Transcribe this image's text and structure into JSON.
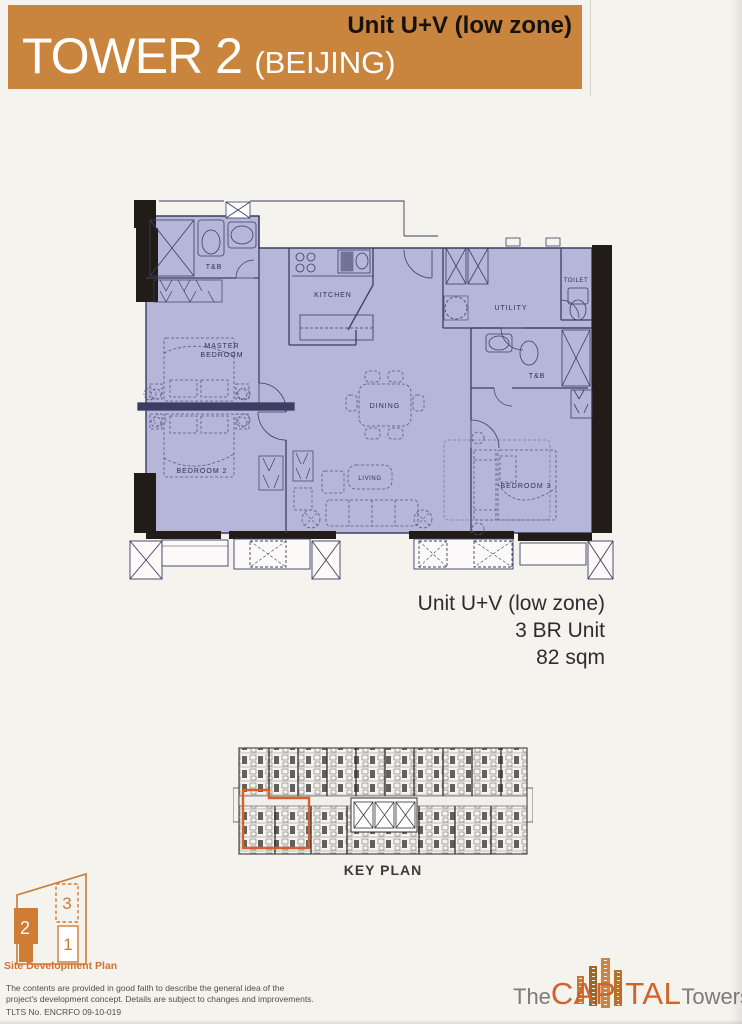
{
  "banner": {
    "title": "TOWER 2",
    "subtitle": "(BEIJING)",
    "unit_label": "Unit U+V (low zone)"
  },
  "floor_plan": {
    "rooms": {
      "tb_top": "T&B",
      "kitchen": "KITCHEN",
      "utility": "UTILITY",
      "toilet": "TOILET",
      "master_line1": "MASTER",
      "master_line2": "BEDROOM",
      "bedroom2": "BEDROOM 2",
      "dining": "DINING",
      "living": "LIVING",
      "tb_right": "T&B",
      "bedroom3": "BEDROOM 3"
    }
  },
  "unit_info": {
    "unit": "Unit U+V (low zone)",
    "type": "3 BR Unit",
    "area": "82 sqm"
  },
  "key_plan": {
    "label": "KEY PLAN"
  },
  "site_plan": {
    "label": "Site Development Plan",
    "tower2": "2",
    "tower3": "3",
    "tower1": "1"
  },
  "disclaimer": {
    "line1": "The contents are provided in good faith to describe the general idea of the",
    "line2": "project's development concept. Details are subject to changes and improvements.",
    "tlts": "TLTS No. ENCRFO 09-10-019"
  },
  "logo": {
    "the": "The",
    "capital": "CAPITAL",
    "towers": "Towers"
  },
  "colors": {
    "banner_orange": "#c9853e",
    "accent_orange": "#d2622c",
    "site_plan_orange": "#d07c34",
    "plan_fill": "#b6b6d9",
    "plan_line": "#3d3d63",
    "wall_black": "#211c17",
    "text_dark": "#2d2d2d"
  }
}
